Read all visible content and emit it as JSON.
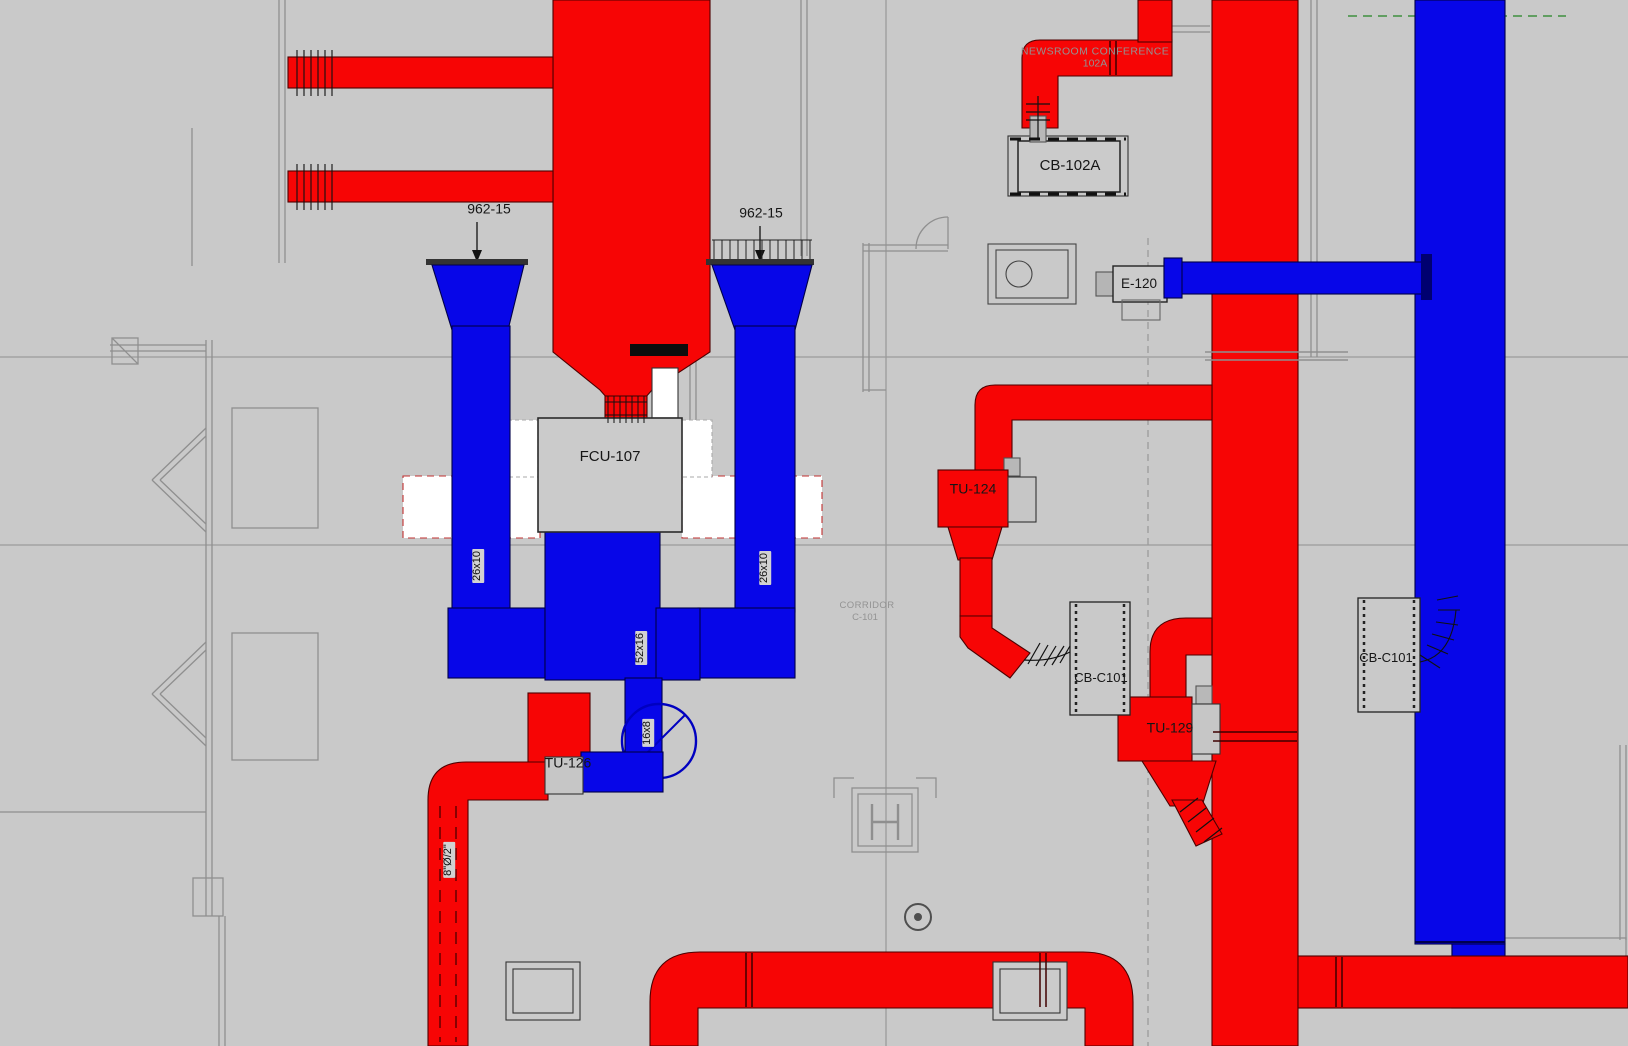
{
  "drawing_type": "hvac-duct-plan",
  "colors": {
    "background": "#c9c9c9",
    "supply_red": "#f70505",
    "red_outline": "#4e0000",
    "return_blue": "#0706e8",
    "blue_outline": "#000048",
    "linework_gray": "#8f8f8f",
    "text_dark": "#161616",
    "text_muted": "#939393",
    "clearance_white": "#ffffff",
    "grid_green": "#3f8f3f"
  },
  "rooms": {
    "newsroom": {
      "name": "NEWSROOM CONFERENCE",
      "number": "102A"
    },
    "corridor": {
      "name": "CORRIDOR",
      "number": "C-101"
    }
  },
  "equipment": {
    "fcu": {
      "tag": "FCU-107"
    },
    "cb102a": {
      "tag": "CB-102A"
    },
    "e120": {
      "tag": "E-120"
    },
    "tu124": {
      "tag": "TU-124"
    },
    "tu126": {
      "tag": "TU-126"
    },
    "tu129": {
      "tag": "TU-129"
    },
    "cbc101_left": {
      "tag": "CB-C101"
    },
    "cbc101_right": {
      "tag": "CB-C101"
    }
  },
  "callouts": {
    "left": "962-15",
    "right": "962-15"
  },
  "duct_sizes": {
    "left_riser": "26x10",
    "right_riser": "26x10",
    "main_riser": "52x16",
    "branch": "16x8",
    "round_runout": "8\"Ø/2\""
  }
}
